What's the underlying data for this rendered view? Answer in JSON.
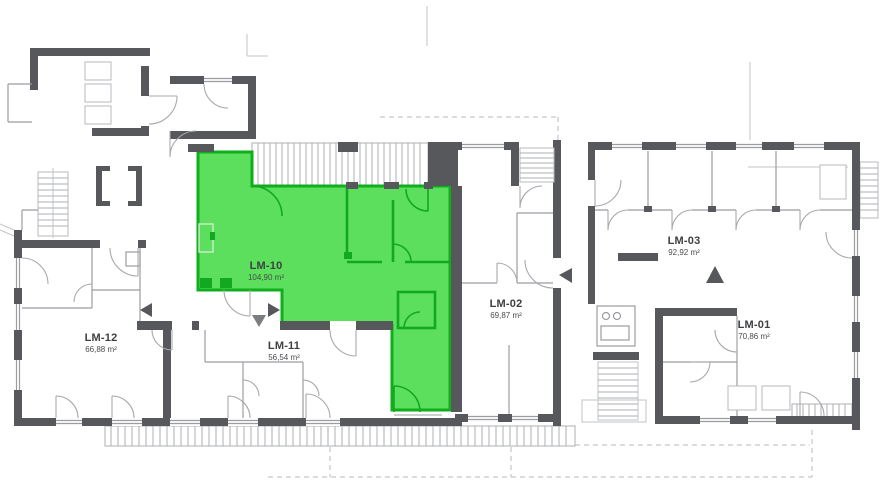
{
  "floorplan": {
    "highlighted_unit": "LM-10",
    "units": [
      {
        "id": "LM-12",
        "area": "66,88 m²",
        "highlighted": false
      },
      {
        "id": "LM-11",
        "area": "56,54 m²",
        "highlighted": false
      },
      {
        "id": "LM-10",
        "area": "104,90 m²",
        "highlighted": true
      },
      {
        "id": "LM-02",
        "area": "69,87 m²",
        "highlighted": false
      },
      {
        "id": "LM-03",
        "area": "92,92 m²",
        "highlighted": false
      },
      {
        "id": "LM-01",
        "area": "70,86 m²",
        "highlighted": false
      }
    ],
    "colors": {
      "highlight_fill": "#5cdf5c",
      "highlight_stroke": "#0fae1d",
      "wall": "#57585c"
    }
  }
}
